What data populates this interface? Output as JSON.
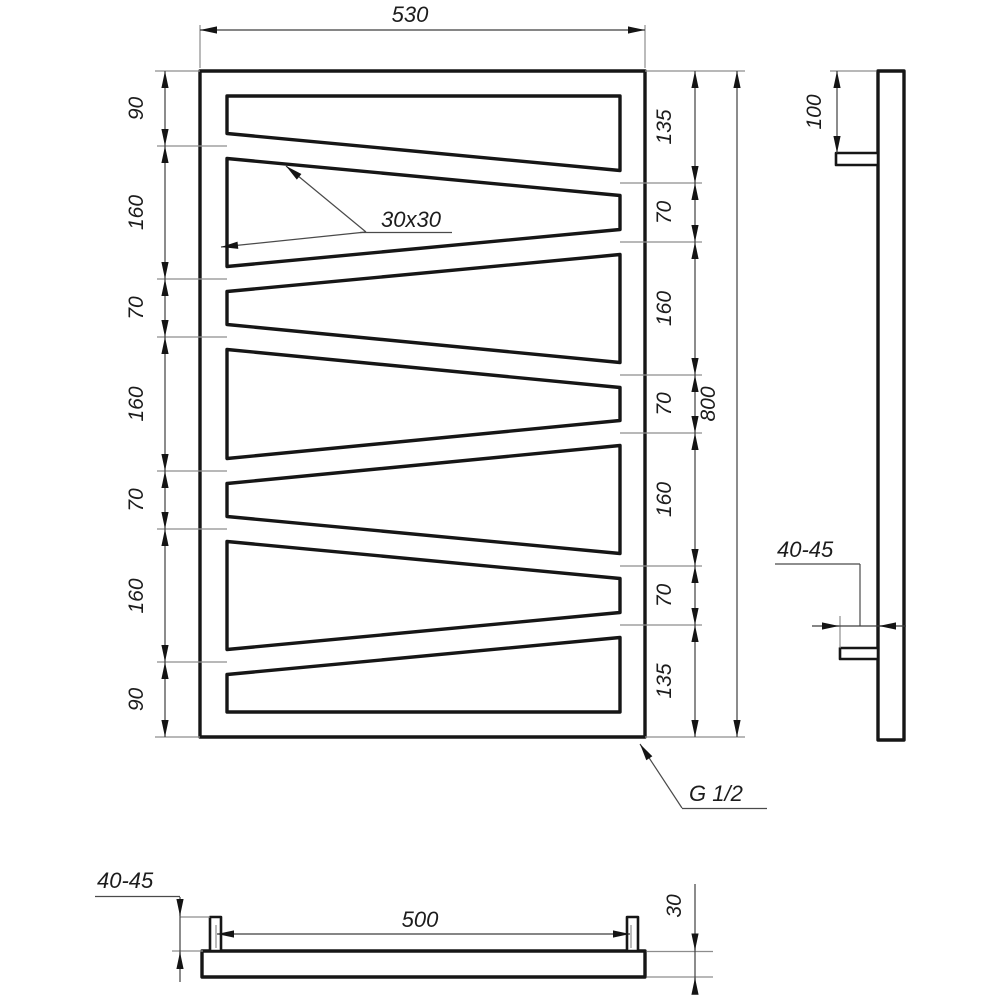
{
  "drawing": {
    "front": {
      "width": "530",
      "height": "800",
      "left_dims": [
        "90",
        "160",
        "70",
        "160",
        "70",
        "160",
        "90"
      ],
      "right_dims": [
        "135",
        "70",
        "160",
        "70",
        "160",
        "70",
        "135"
      ],
      "tube_size": "30x30",
      "connection": "G 1/2"
    },
    "side": {
      "top_bracket_offset": "100",
      "wall_distance": "40-45"
    },
    "bottom": {
      "bracket_span": "500",
      "wall_distance": "40-45",
      "tube_depth": "30"
    }
  }
}
